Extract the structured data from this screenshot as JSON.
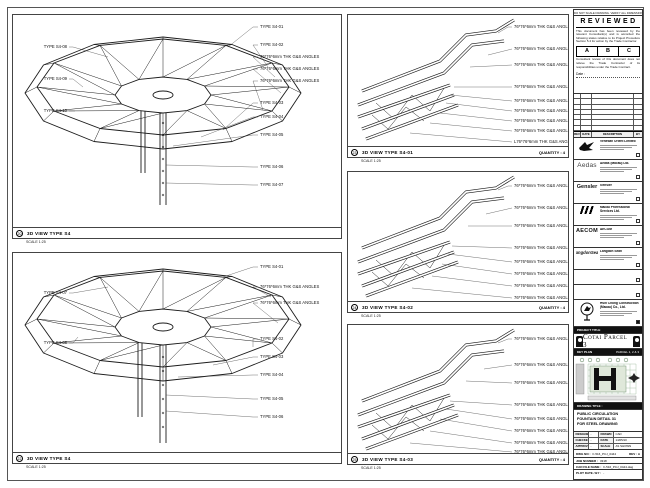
{
  "sheet": {
    "top_note": "DO NOT SCALE DRAWING. VERIFY ALL DIMENSIONS ON SITE.",
    "reviewed": {
      "title": "REVIEWED",
      "body1": "This document has been reviewed by the relevant Consultant(s) and is accorded the following status relative to its Project Procedure Section 5.4 for action by the Trade Contractor.",
      "grade_a": "A",
      "grade_b": "B",
      "grade_c": "C",
      "body2": "Consultant review of this document does not relieve the Trade Contractor of its responsibilities under the Trade Contract.",
      "date_label": "Date :"
    },
    "revision": {
      "col_rev": "REV",
      "col_date": "DATE",
      "col_desc": "DESCRIPTION",
      "col_by": "BY"
    },
    "companies": [
      {
        "name": "Venetian Orient Limited",
        "logo_text": ""
      },
      {
        "name": "Aedas (Macau) Ltd.",
        "logo_text": "Aedas"
      },
      {
        "name": "Gensler",
        "logo_text": "Gensler"
      },
      {
        "name": "Macau Professional Services Ltd.",
        "logo_text": ""
      },
      {
        "name": "AECOM",
        "logo_text": "AECOM"
      },
      {
        "name": "Langdon Seah",
        "logo_text": "LangdonSeah"
      },
      {
        "name": "Hsin Chong Construction (Macau) Co., Ltd.",
        "logo_text": ""
      }
    ],
    "project": {
      "bar": "PROJECT TITLE",
      "title": "Cotai Parcel 3"
    },
    "key_plan": {
      "bar": "KEY PLAN",
      "parcel": "PARCEL 1, 2 & 3"
    },
    "drawing_title": {
      "bar": "DRAWING TITLE :",
      "line1": "PUBLIC CIRCULATION",
      "line2": "FOUNTAIN DETAIL 31",
      "line3": "FOR STEEL DRAWING"
    },
    "info": {
      "r1l1": "DESIGNED",
      "r1v1": "-",
      "r1l2": "DRAWN",
      "r1v2": "CAD",
      "r2l1": "CHECKED",
      "r2v1": "-",
      "r2l2": "DATE",
      "r2v2": "14/05/10",
      "r3l1": "APPROVED",
      "r3v1": "-",
      "r3l2": "SCALE",
      "r3v2": "AS SHOWN"
    },
    "dwg": {
      "label": "DWG NO :",
      "value": "F-516_PCJ_0444",
      "rev": "REV : A"
    },
    "job": {
      "label": "JOB NUMBER :",
      "value": "3318"
    },
    "cad": {
      "label": "CAD FILE NAME :",
      "value": "F-516_PCJ_0444.dwg"
    },
    "plot": {
      "label": "PLOT DATE / BY :",
      "value": "-"
    }
  },
  "viewports": {
    "A": {
      "marker": "20",
      "title": "3D VIEW TYPE S4",
      "scale": "SCALE 1:25",
      "right_labels": [
        "TYPE S4-01",
        "TYPE S4-02",
        "76*76*6mm THK G&S ANGLES",
        "76*76*6mm THK G&S ANGLES",
        "76*76*6mm THK G&S ANGLES",
        "TYPE S4-03",
        "TYPE S4-04",
        "TYPE S4-05",
        "TYPE S4-06",
        "TYPE S4-07"
      ],
      "left_labels": [
        "TYPE S4-08",
        "TYPE S4-09",
        "TYPE S4-10"
      ]
    },
    "B": {
      "marker": "22",
      "title": "3D VIEW TYPE S4",
      "scale": "SCALE 1:25",
      "right_labels": [
        "TYPE S4-01",
        "76*76*6mm THK G&S ANGLES",
        "76*76*6mm THK G&S ANGLES",
        "TYPE S4-02",
        "TYPE S4-03",
        "TYPE S4-04",
        "TYPE S4-05",
        "TYPE S4-06"
      ],
      "left_labels": [
        "TYPE S4-07",
        "TYPE S4-08"
      ]
    },
    "C": {
      "marker": "23",
      "title": "3D VIEW TYPE S4-01",
      "scale": "SCALE 1:25",
      "quantity": "QUANTITY : 4",
      "labels": [
        "76*76*6mm THK G&S ANGLES",
        "76*76*6mm THK G&S ANGLES",
        "76*76*6mm THK G&S ANGLES",
        "76*76*6mm THK G&S ANGLES",
        "76*76*6mm THK G&S ANGLES",
        "76*76*6mm THK G&S ANGLES",
        "76*76*6mm THK G&S ANGLES",
        "76*76*6mm THK G&S ANGLES",
        "L76*76*6mm THK G&S ANGLES"
      ]
    },
    "D": {
      "marker": "24",
      "title": "3D VIEW TYPE S4-02",
      "scale": "SCALE 1:25",
      "quantity": "QUANTITY : 4",
      "labels": [
        "76*76*6mm THK G&S ANGLES",
        "76*76*6mm THK G&S ANGLES",
        "76*76*6mm THK G&S ANGLES",
        "76*76*6mm THK G&S ANGLES",
        "76*76*6mm THK G&S ANGLES",
        "76*76*6mm THK G&S ANGLES",
        "76*76*6mm THK G&S ANGLES",
        "76*76*6mm THK G&S ANGLES"
      ]
    },
    "E": {
      "marker": "25",
      "title": "3D VIEW TYPE S4-03",
      "scale": "SCALE 1:25",
      "quantity": "QUANTITY : 4",
      "labels": [
        "76*76*6mm THK G&S ANGLES",
        "76*76*6mm THK G&S ANGLES",
        "76*76*6mm THK G&S ANGLES",
        "76*76*6mm THK G&S ANGLES",
        "76*76*6mm THK G&S ANGLES",
        "76*76*6mm THK G&S ANGLES",
        "76*76*6mm THK G&S ANGLES",
        "76*76*6mm THK G&S ANGLES"
      ]
    }
  }
}
